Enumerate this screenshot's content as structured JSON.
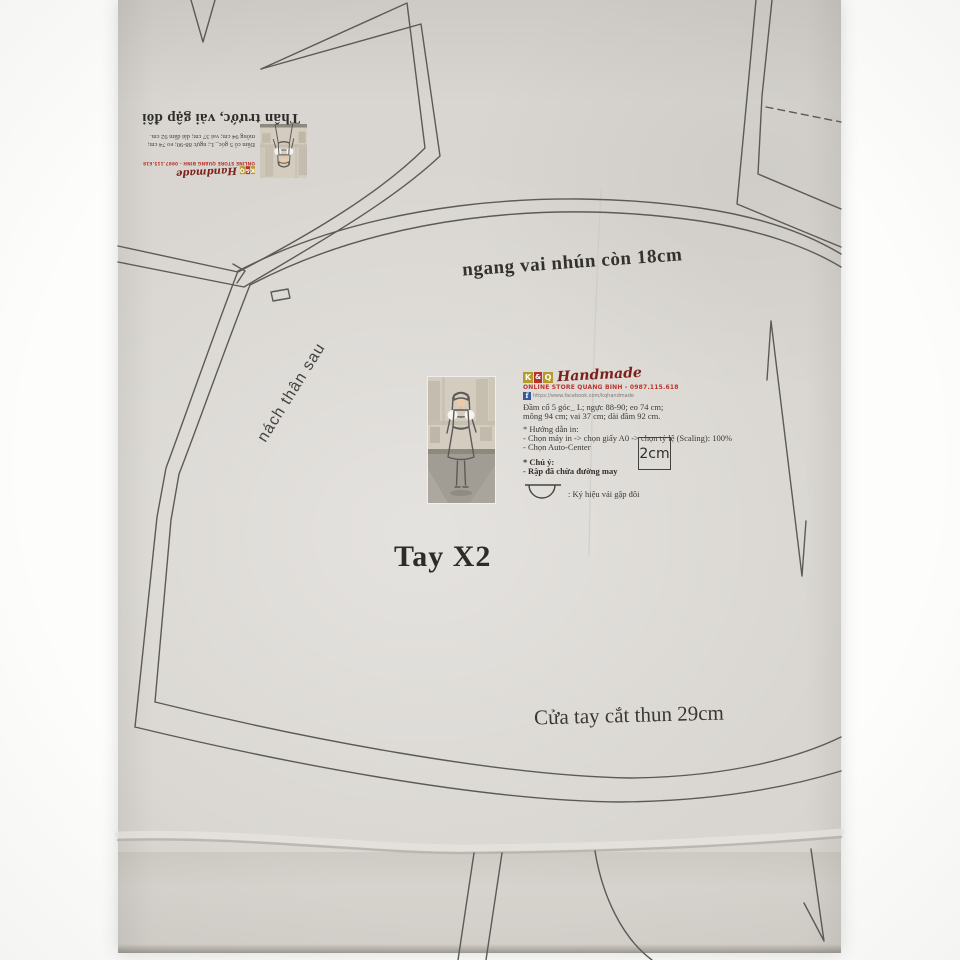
{
  "labels": {
    "top_curve": "ngang vai nhún còn 18cm",
    "armhole": "nách thân sau",
    "sleeve_title": "Tay X2",
    "hem": "Cửa tay cắt thun 29cm"
  },
  "mini_card": {
    "title": "Thân trước, vải gập đôi",
    "desc_line1": "Đầm cổ 5 góc_ L; ngực 88-90; eo 74 cm;",
    "desc_line2": "mông 94 cm; vai 37 cm; dài đầm 92 cm."
  },
  "info_card": {
    "brand": {
      "letters": [
        "K",
        "&",
        "Q"
      ],
      "script": "Handmade",
      "tagline": "ONLINE STORE QUANG BINH - 0987.115.618",
      "facebook": "https://www.facebook.com/kqhandmade"
    },
    "desc_line1": "Đầm cổ 5 góc_ L; ngực 88-90; eo 74 cm;",
    "desc_line2": "mông 94 cm; vai 37 cm; dài đầm 92 cm.",
    "print_title": "* Hướng dẫn in:",
    "print_step1": "- Chọn máy in -> chọn giấy A0 -> chọn tỷ lệ (Scaling): 100%",
    "print_step2": "- Chọn Auto-Center",
    "note_title": "* Chú ý:",
    "note_body": "- Rập đã chừa đường may",
    "fold_caption": ": Ký hiệu vải gập đôi",
    "scale_label": "2cm"
  },
  "colors": {
    "paper": "#d9d6d1",
    "pattern_line": "#5c5a57",
    "ink": "#33312e",
    "brand_gold": "#b59a2e",
    "brand_red": "#b5342a",
    "facebook_blue": "#3b5998"
  }
}
